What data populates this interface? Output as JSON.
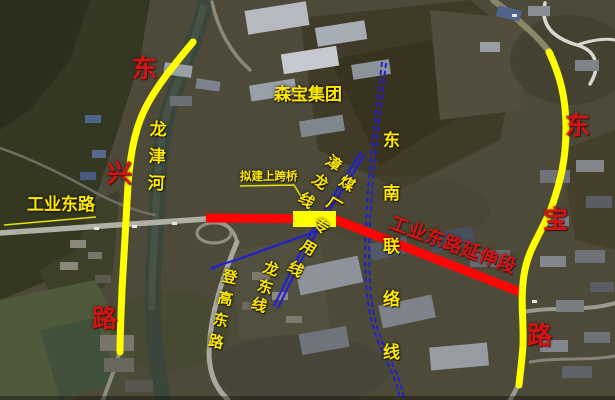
{
  "map": {
    "colors": {
      "highlight_road": "#ffff00",
      "extension_line": "#fb0505",
      "railway": "#2121cd",
      "label_yellow": "#ffe900",
      "label_red": "#d51313"
    },
    "labels": {
      "company": "森宝集团",
      "river": "龙津河",
      "industrial_east_road": "工业东路",
      "proposed_overpass": "拟建上跨桥",
      "extension_segment": "工业东路延伸段",
      "denggao_east_road": "登高东路",
      "zhanglong_line": "漳龙线",
      "coal_plant_spur": "煤厂专用线",
      "southeast_link_line": "东南联络线",
      "longdong_line": "龙东线",
      "left_road": {
        "name": "东兴路",
        "chars": [
          "东",
          "兴",
          "路"
        ]
      },
      "right_road": {
        "name": "东宝路",
        "chars": [
          "东",
          "宝",
          "路"
        ]
      }
    }
  }
}
